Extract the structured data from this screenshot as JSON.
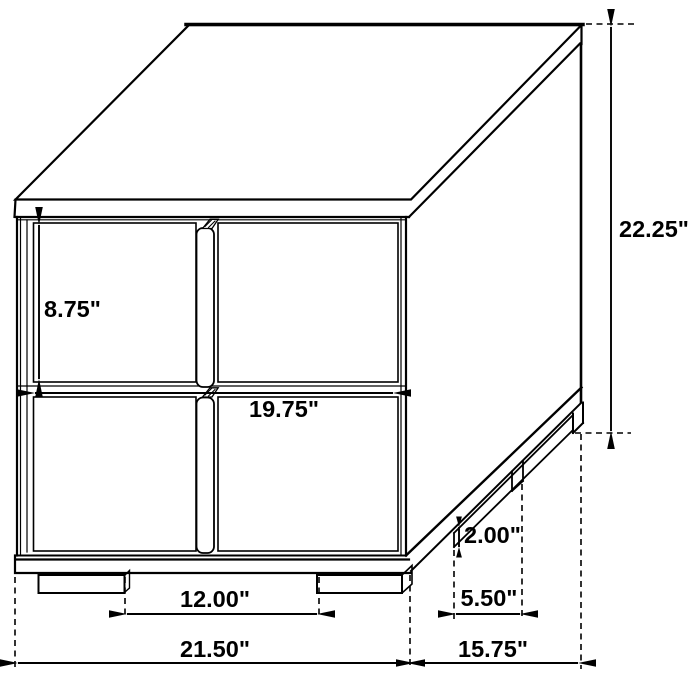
{
  "diagram": {
    "name": "nightstand-dimension-diagram",
    "unit": "inches",
    "background_color": "#ffffff",
    "line_color": "#000000",
    "dimensions": [
      {
        "id": "drawer-height",
        "label": "8.75\"",
        "value": 8.75,
        "axis": "v",
        "x1": 39,
        "y1": 225,
        "x2": 39,
        "y2": 379,
        "lx": 44,
        "ly": 317,
        "anchor": "start"
      },
      {
        "id": "overall-height",
        "label": "22.25\"",
        "value": 22.25,
        "axis": "v",
        "x1": 611,
        "y1": 27,
        "x2": 611,
        "y2": 431,
        "lx": 619,
        "ly": 237,
        "anchor": "start"
      },
      {
        "id": "drawer-width",
        "label": "19.75\"",
        "value": 19.75,
        "axis": "h",
        "x1": 35,
        "y1": 393,
        "x2": 393,
        "y2": 393,
        "lx": 284,
        "ly": 417,
        "anchor": "middle"
      },
      {
        "id": "leg-height",
        "label": "2.00\"",
        "value": 2.0,
        "axis": "v",
        "x1": 459,
        "y1": 527,
        "x2": 459,
        "y2": 547,
        "lx": 464,
        "ly": 543,
        "anchor": "start",
        "small": true
      },
      {
        "id": "side-leg-spacing",
        "label": "5.50\"",
        "value": 5.5,
        "axis": "h",
        "x1": 456,
        "y1": 614,
        "x2": 520,
        "y2": 614,
        "lx": 489,
        "ly": 606,
        "anchor": "middle"
      },
      {
        "id": "front-leg-spacing",
        "label": "12.00\"",
        "value": 12.0,
        "axis": "h",
        "x1": 127,
        "y1": 614,
        "x2": 317,
        "y2": 614,
        "lx": 215,
        "ly": 607,
        "anchor": "middle"
      },
      {
        "id": "overall-width",
        "label": "21.50\"",
        "value": 21.5,
        "axis": "h",
        "x1": 18,
        "y1": 663,
        "x2": 407,
        "y2": 663,
        "lx": 215,
        "ly": 657,
        "anchor": "middle"
      },
      {
        "id": "overall-depth",
        "label": "15.75\"",
        "value": 15.75,
        "axis": "h",
        "x1": 414,
        "y1": 663,
        "x2": 578,
        "y2": 663,
        "lx": 493,
        "ly": 657,
        "anchor": "middle"
      }
    ],
    "extension_lines": [
      {
        "id": "ext-left-bottom",
        "x1": 15,
        "y1": 577,
        "x2": 15,
        "y2": 669
      },
      {
        "id": "ext-front-leg-inner",
        "x1": 125,
        "y1": 577,
        "x2": 125,
        "y2": 619
      },
      {
        "id": "ext-front-leg-right",
        "x1": 319,
        "y1": 577,
        "x2": 319,
        "y2": 619
      },
      {
        "id": "ext-front-right",
        "x1": 410,
        "y1": 575,
        "x2": 410,
        "y2": 669
      },
      {
        "id": "ext-side-rail-front",
        "x1": 454,
        "y1": 550,
        "x2": 454,
        "y2": 619
      },
      {
        "id": "ext-side-leg-rear",
        "x1": 522,
        "y1": 484,
        "x2": 522,
        "y2": 619
      },
      {
        "id": "ext-rear-bottom",
        "x1": 581,
        "y1": 434,
        "x2": 581,
        "y2": 669
      },
      {
        "id": "ext-top-corner",
        "x1": 586,
        "y1": 24,
        "x2": 634,
        "y2": 24
      },
      {
        "id": "ext-floor-rear",
        "x1": 575,
        "y1": 433,
        "x2": 631,
        "y2": 433
      }
    ]
  }
}
